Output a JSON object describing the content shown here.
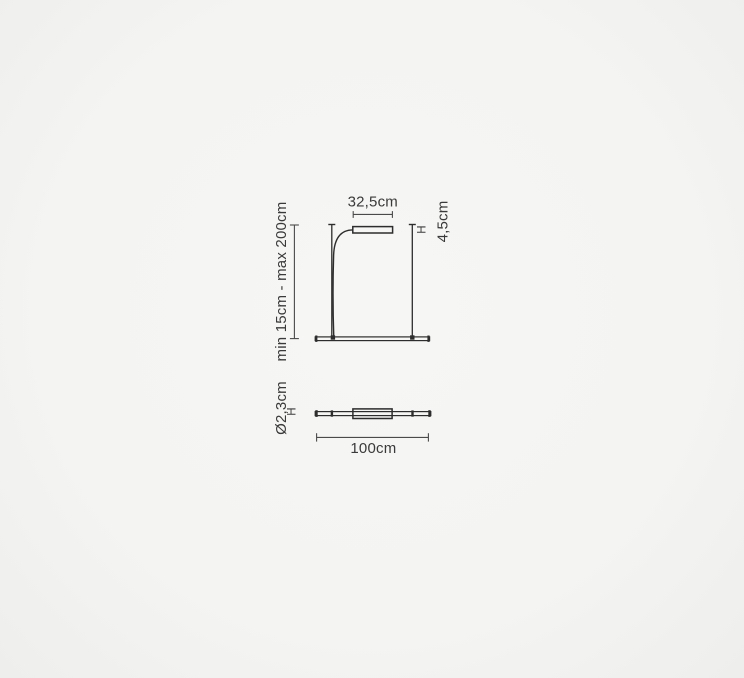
{
  "title": "Suspension lamp dimension drawing",
  "colors": {
    "background": "#f4f4f2",
    "line": "#2d2d2d",
    "dimension": "#4a4a4a",
    "text": "#3a3a3a"
  },
  "front_view": {
    "head_width": "32,5cm",
    "suspension_range": "min 15cm - max 200cm",
    "head_height_marker": "H",
    "head_height": "4,5cm"
  },
  "top_view": {
    "tube_diameter": "Ø2,3cm",
    "tube_diameter_marker": "H",
    "bar_length": "100cm"
  }
}
